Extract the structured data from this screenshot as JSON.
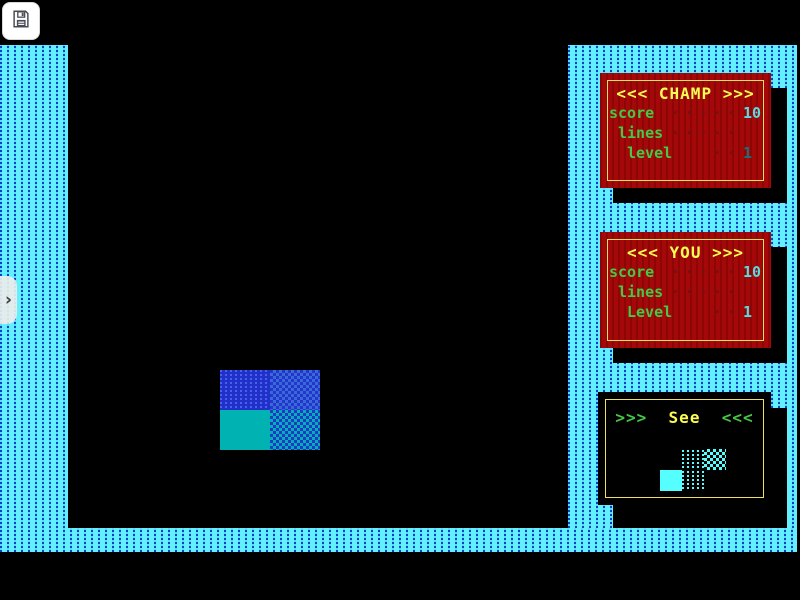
{
  "app": {
    "name": "tetris-game-screen",
    "background": "#000000"
  },
  "toolbar": {
    "save_button": {
      "icon": "floppy-disk-icon",
      "tooltip": ""
    }
  },
  "side_tab": {
    "chevron": "›"
  },
  "theme": {
    "frame_cyan": "#62f0ff",
    "frame_dash_blue": "#0742c6",
    "panel_red": "#a40808",
    "panel_border_yellow": "#f0e060",
    "title_yellow": "#fcfc54",
    "label_green": "#46c846",
    "dot_dark_red": "#701212",
    "value_cyan": "#58dce0",
    "value_dark_teal": "#1d6f74",
    "block_blue": "#2030c8",
    "block_teal": "#00b2b2",
    "preview_cyan": "#55ffff"
  },
  "panels": {
    "champ": {
      "title": "<<< CHAMP >>>",
      "rows": [
        {
          "label": "score",
          "dots": "·····",
          "value": "10"
        },
        {
          "label": "lines",
          "dots": "·····",
          "value": ""
        },
        {
          "label": "level",
          "dots": "··",
          "value": "1"
        }
      ]
    },
    "you": {
      "title": "<<< YOU >>>",
      "rows": [
        {
          "label": "score",
          "dots": "·····",
          "value": "10"
        },
        {
          "label": "lines",
          "dots": "·····",
          "value": ""
        },
        {
          "label": "Level",
          "dots": "··",
          "value": "1"
        }
      ]
    },
    "see": {
      "title_prefix": ">>>",
      "title_word": "See",
      "title_suffix": "<<<",
      "next_piece": "S-piece"
    }
  },
  "playfield": {
    "current_piece": "O-piece (2x2 square, blue/teal dithered blocks)"
  }
}
